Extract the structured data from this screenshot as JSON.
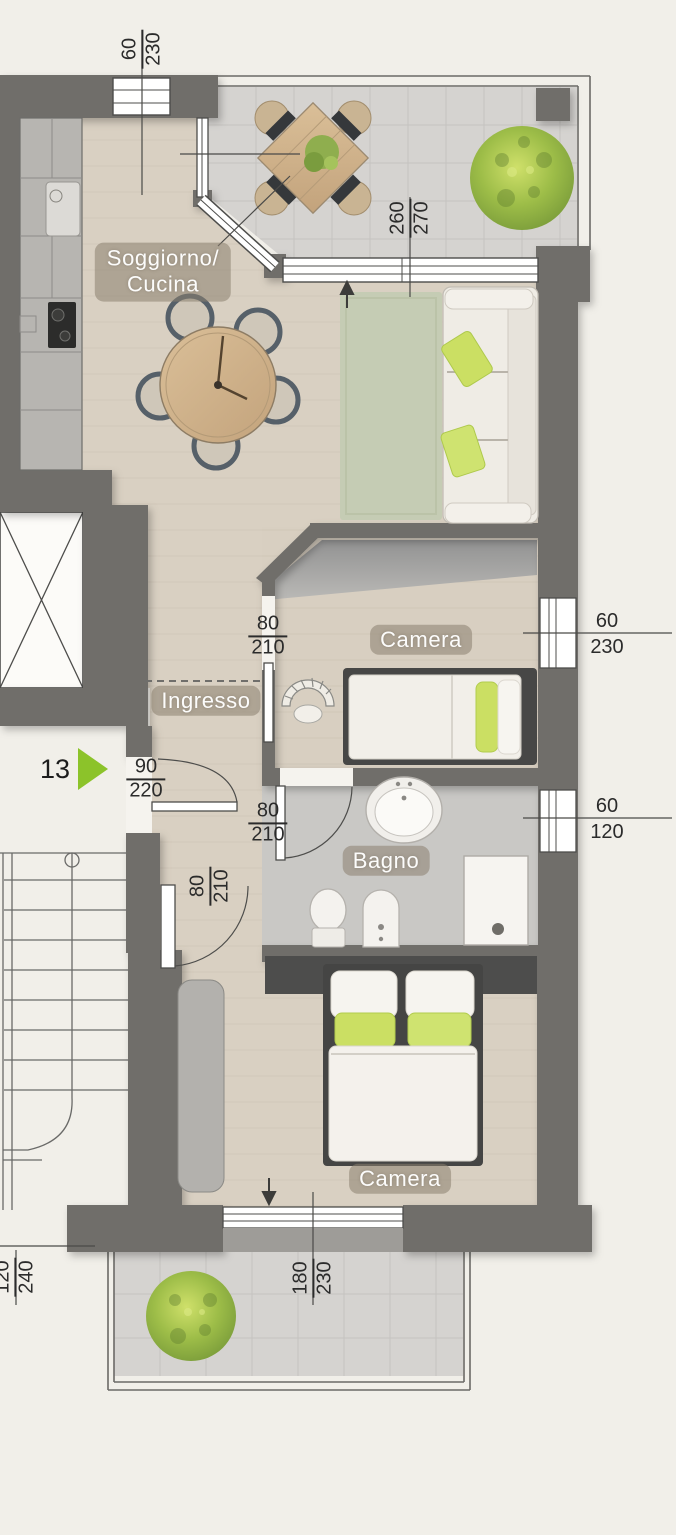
{
  "unit": {
    "marker_number": "13"
  },
  "rooms": {
    "living": {
      "label_line1": "Soggiorno/",
      "label_line2": "Cucina"
    },
    "entry": {
      "label": "Ingresso"
    },
    "bedroom1": {
      "label": "Camera"
    },
    "bathroom": {
      "label": "Bagno"
    },
    "bedroom2": {
      "label": "Camera"
    }
  },
  "dimensions": {
    "top_window": {
      "width": "60",
      "height": "230"
    },
    "terrace_door": {
      "width": "260",
      "height": "270"
    },
    "bedroom1_door": {
      "width": "80",
      "height": "210"
    },
    "entrance_door": {
      "width": "90",
      "height": "220"
    },
    "bathroom_door": {
      "width": "80",
      "height": "210"
    },
    "bedroom2_door": {
      "width": "80",
      "height": "210"
    },
    "bedroom1_window": {
      "width": "60",
      "height": "230"
    },
    "bathroom_window": {
      "width": "60",
      "height": "120"
    },
    "bedroom2_window": {
      "width": "180",
      "height": "230"
    },
    "stairwell_window": {
      "width": "120",
      "height": "240"
    }
  },
  "colors": {
    "wall": "#6f6e6b",
    "wood_floor": "#d9d0c2",
    "tile_floor": "#d5d3d0",
    "bath_floor": "#c9c8c5",
    "rug": "#c5ccb4",
    "marker_green": "#8cc32a",
    "pillow_green": "#cbdf63",
    "label_text": "#ffffff"
  }
}
